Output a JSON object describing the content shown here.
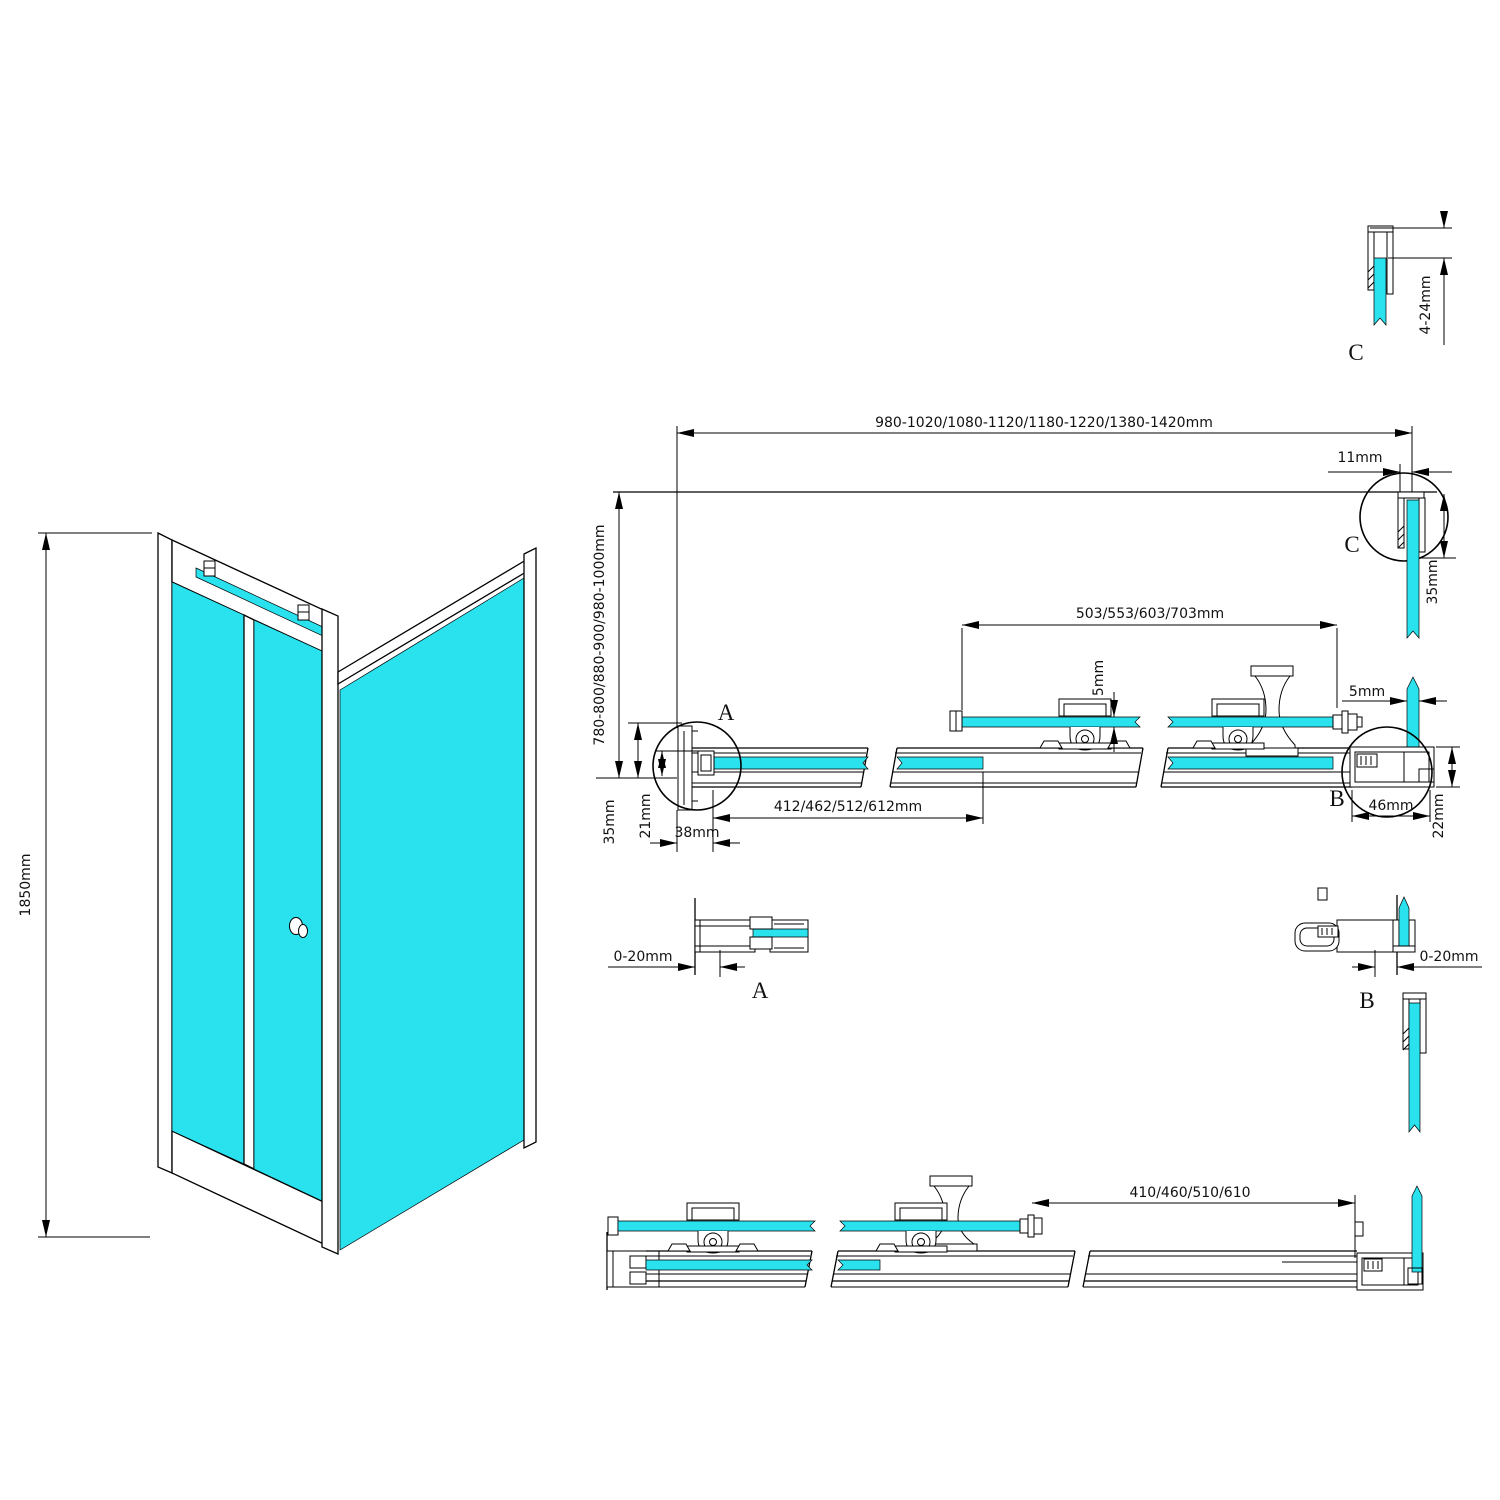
{
  "colors": {
    "glass": "#2ae2ee",
    "line": "#000000",
    "background": "#ffffff"
  },
  "iso_view": {
    "height_dim": "1850mm"
  },
  "plan_view": {
    "overall_width_dim": "980-1020/1080-1120/1180-1220/1380-1420mm",
    "depth_dim": "780-800/880-900/980-1000mm",
    "top_gap_dim": "11mm",
    "side_channel_dim": "35mm",
    "door_glass_dim": "503/553/603/703mm",
    "door_glass_thickness_dim": "5mm",
    "side_glass_thickness_dim": "5mm",
    "fixed_glass_dim": "412/462/512/612mm",
    "wall_profile_dim": "38mm",
    "profile_depth_dim": "35mm",
    "glass_inset_dim": "21mm",
    "corner_width_dim": "46mm",
    "corner_height_dim": "22mm",
    "detail_a_label": "A",
    "detail_b_label": "B",
    "detail_c_label": "C"
  },
  "detail_c": {
    "label": "C",
    "adjust_dim": "4-24mm"
  },
  "detail_a": {
    "label": "A",
    "adjust_dim": "0-20mm"
  },
  "detail_b": {
    "label": "B",
    "adjust_dim": "0-20mm"
  },
  "bottom_view": {
    "door_glass_dim": "410/460/510/610"
  }
}
